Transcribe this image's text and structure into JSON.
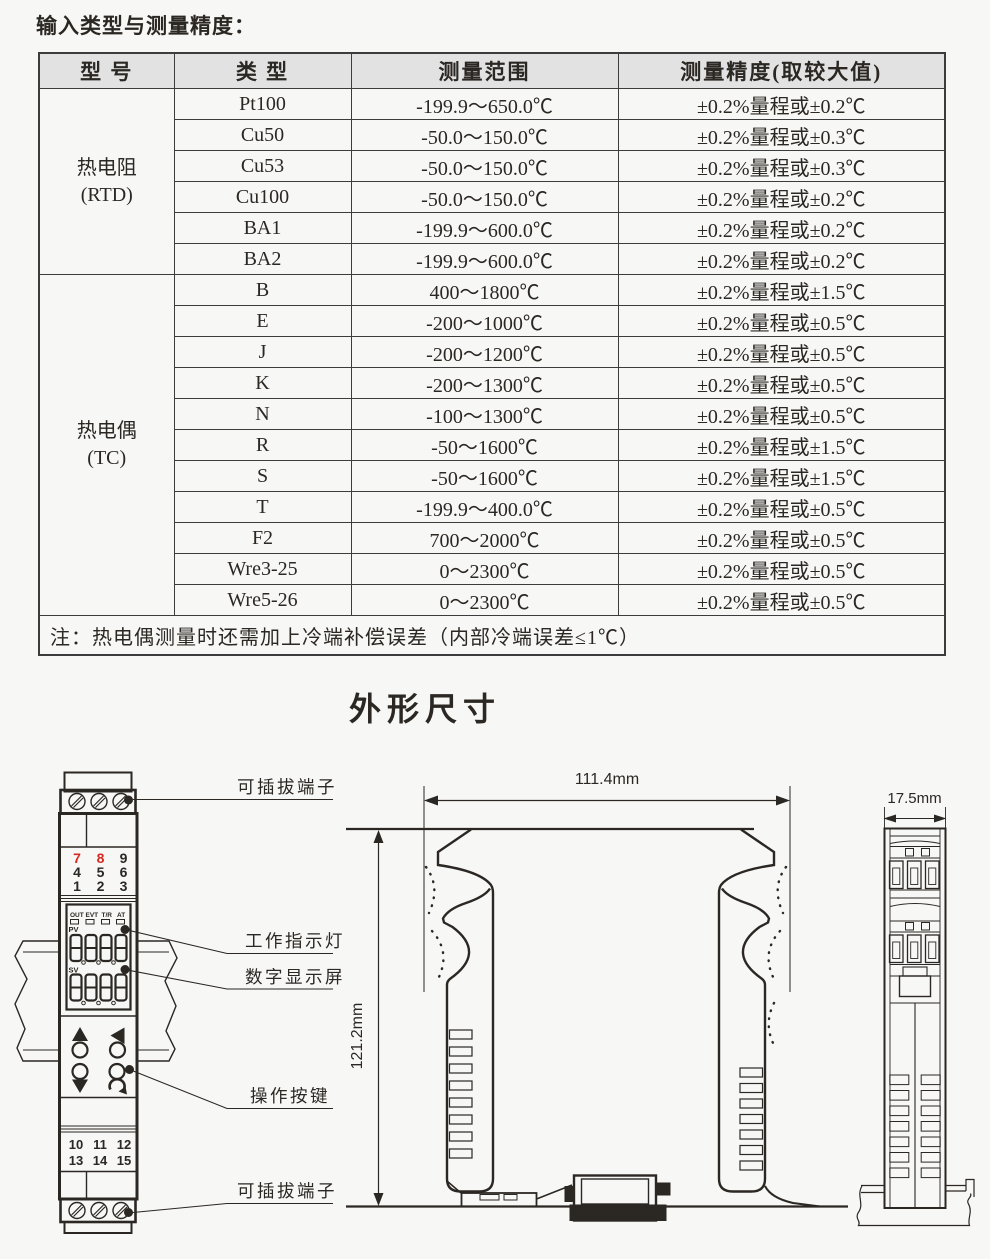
{
  "colors": {
    "ink": "#2b2723",
    "red": "#d42a20",
    "table_border": "#3c3c3c",
    "header_bg": "#e2e2e2",
    "page_bg": "#f7f7f6"
  },
  "input_section": {
    "title": "输入类型与测量精度：",
    "table": {
      "headers": [
        "型 号",
        "类 型",
        "测量范围",
        "测量精度(取较大值)"
      ],
      "groups": [
        {
          "model": "热电阻",
          "model_sub": "(RTD)",
          "rows": [
            [
              "Pt100",
              "-199.9～650.0℃",
              "±0.2%量程或±0.2℃"
            ],
            [
              "Cu50",
              "-50.0～150.0℃",
              "±0.2%量程或±0.3℃"
            ],
            [
              "Cu53",
              "-50.0～150.0℃",
              "±0.2%量程或±0.3℃"
            ],
            [
              "Cu100",
              "-50.0～150.0℃",
              "±0.2%量程或±0.2℃"
            ],
            [
              "BA1",
              "-199.9～600.0℃",
              "±0.2%量程或±0.2℃"
            ],
            [
              "BA2",
              "-199.9～600.0℃",
              "±0.2%量程或±0.2℃"
            ]
          ]
        },
        {
          "model": "热电偶",
          "model_sub": "(TC)",
          "rows": [
            [
              "B",
              "400～1800℃",
              "±0.2%量程或±1.5℃"
            ],
            [
              "E",
              "-200～1000℃",
              "±0.2%量程或±0.5℃"
            ],
            [
              "J",
              "-200～1200℃",
              "±0.2%量程或±0.5℃"
            ],
            [
              "K",
              "-200～1300℃",
              "±0.2%量程或±0.5℃"
            ],
            [
              "N",
              "-100～1300℃",
              "±0.2%量程或±0.5℃"
            ],
            [
              "R",
              "-50～1600℃",
              "±0.2%量程或±1.5℃"
            ],
            [
              "S",
              "-50～1600℃",
              "±0.2%量程或±1.5℃"
            ],
            [
              "T",
              "-199.9～400.0℃",
              "±0.2%量程或±0.5℃"
            ],
            [
              "F2",
              "700～2000℃",
              "±0.2%量程或±0.5℃"
            ],
            [
              "Wre3-25",
              "0～2300℃",
              "±0.2%量程或±0.5℃"
            ],
            [
              "Wre5-26",
              "0～2300℃",
              "±0.2%量程或±0.5℃"
            ]
          ]
        }
      ],
      "note": "注：热电偶测量时还需加上冷端补偿误差（内部冷端误差≤1℃）"
    }
  },
  "outline_section": {
    "title": "外形尺寸",
    "callouts": {
      "terminal_top": "可插拔端子",
      "indicator": "工作指示灯",
      "display": "数字显示屏",
      "keys": "操作按键",
      "terminal_bottom": "可插拔端子"
    },
    "dimensions": {
      "width": "111.4mm",
      "height": "121.2mm",
      "depth": "17.5mm"
    },
    "device": {
      "status_leds": [
        "OUT",
        "EVT",
        "T/R",
        "AT"
      ],
      "pv_label": "PV",
      "sv_label": "SV",
      "pv_value": "8888",
      "sv_value": "8888",
      "terminals_top": [
        "7",
        "8",
        "9",
        "4",
        "5",
        "6",
        "1",
        "2",
        "3"
      ],
      "terminals_bottom": [
        "10",
        "11",
        "12",
        "13",
        "14",
        "15"
      ]
    }
  }
}
